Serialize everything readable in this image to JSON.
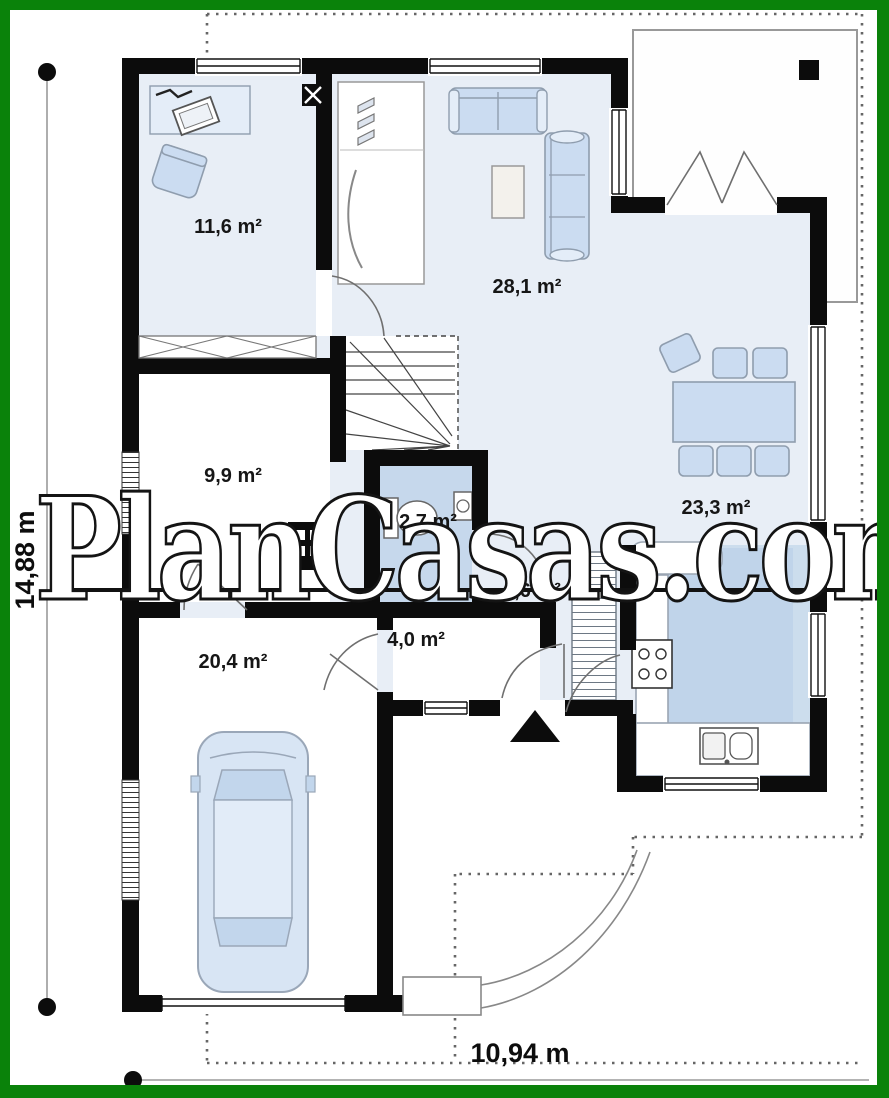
{
  "watermark": "PlanCasas.com",
  "dimensions": {
    "height_label": "14,88 m",
    "width_label": "10,94 m"
  },
  "rooms": [
    {
      "id": "office",
      "area_label": "11,6 m²"
    },
    {
      "id": "living-room",
      "area_label": "28,1 m²"
    },
    {
      "id": "utility-room",
      "area_label": "9,9 m²"
    },
    {
      "id": "wc",
      "area_label": "2,7 m²"
    },
    {
      "id": "dining-area",
      "area_label": "23,3 m²"
    },
    {
      "id": "hall",
      "area_label": "4,6 m²"
    },
    {
      "id": "vestibule",
      "area_label": "4,0 m²"
    },
    {
      "id": "garage",
      "area_label": "20,4 m²"
    }
  ],
  "icons": {
    "entrance_arrow": "▲ filled triangle marking main entrance",
    "chimney": "black square with white X",
    "boiler": "black box with 2x2 white grid",
    "terrace_column": "small black square"
  },
  "colors": {
    "frame_green": "#0a820a",
    "wall_black": "#0c0c0c",
    "floor_light": "#e8eef6",
    "floor_kitchen": "#ccdded",
    "floor_wc": "#c6d8ec",
    "furniture_fill": "#cbdcf1",
    "furniture_stroke": "#8f9dae"
  }
}
